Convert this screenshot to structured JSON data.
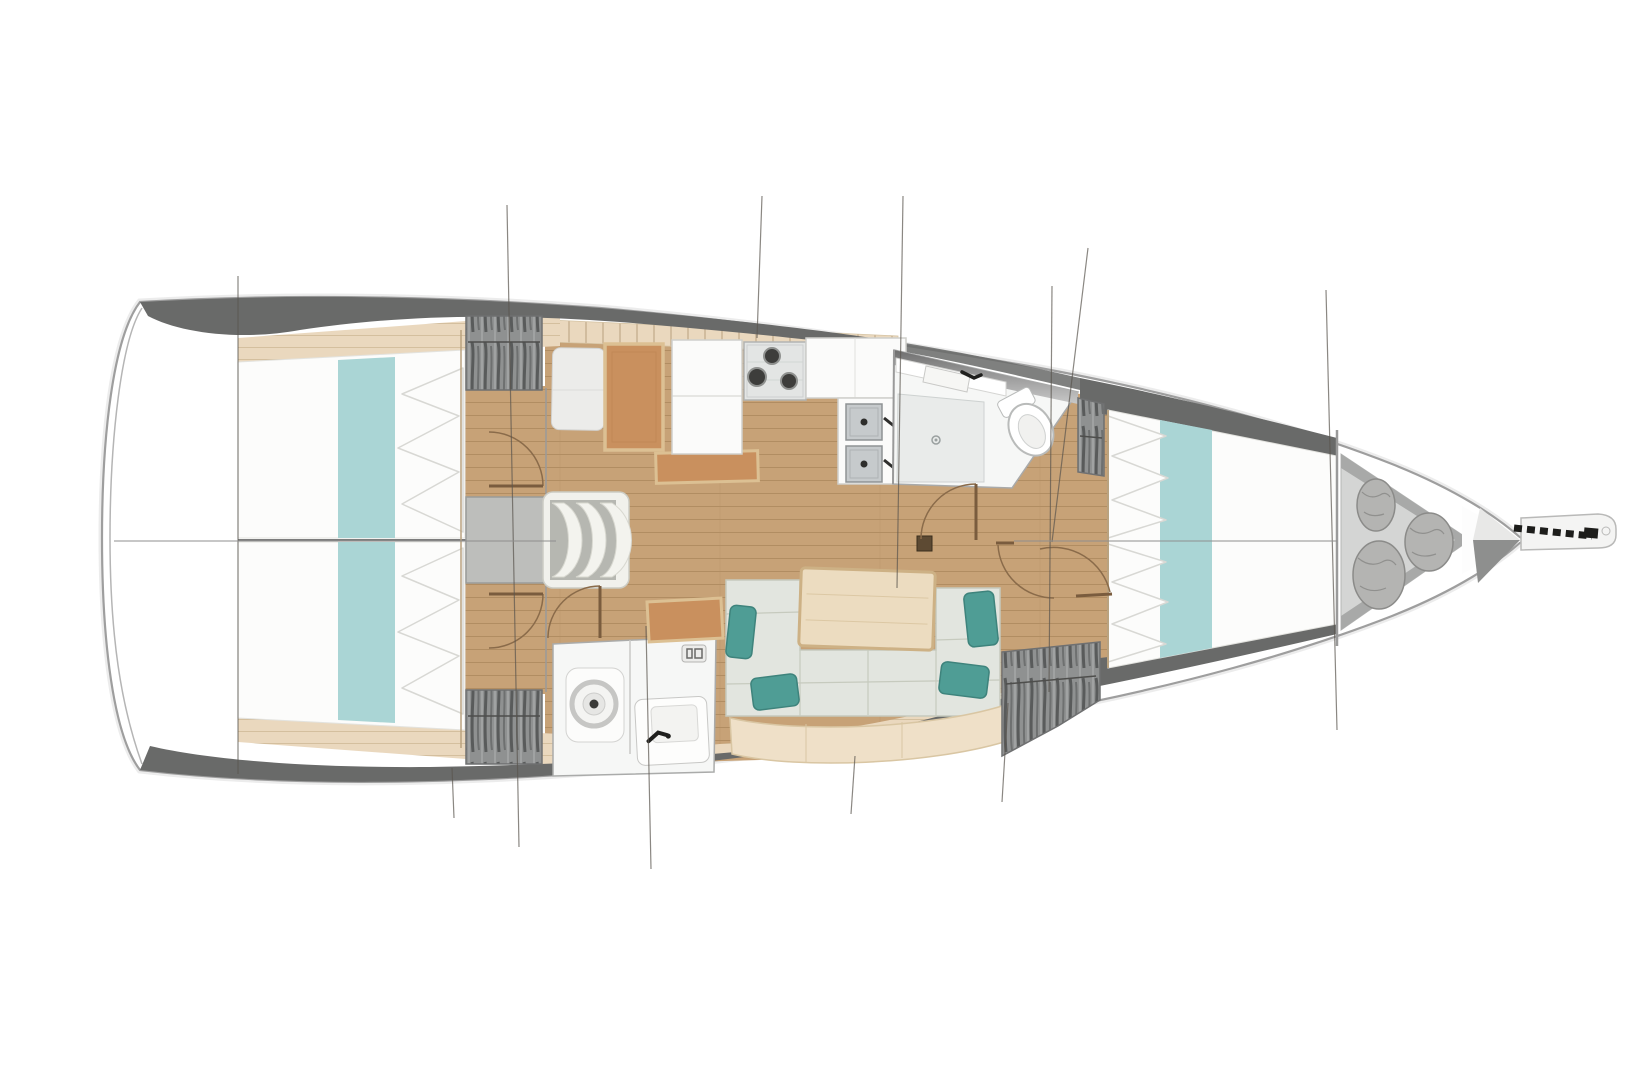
{
  "meta": {
    "title": "Sailing yacht interior floor plan — overhead view, bow to the right"
  },
  "palette": {
    "hull_outline": "#9e9e9e",
    "deck_band": "#696a69",
    "floor_wood": "#c7a277",
    "floor_plank_line": "#b18d62",
    "trim_wood_light": "#ead8be",
    "bedding_white": "#fcfcfb",
    "bed_runner_teal": "#aad5d5",
    "cushion_teal": "#4f9d95",
    "sofa_fabric": "#e2e5df",
    "sofa_backrest": "#efe0c8",
    "table_wood": "#ecdcc0",
    "seat_orange": "#c9905e",
    "orange_trim": "#dcc093",
    "wardrobe_grey": "#8f9191",
    "locker_grey": "#d4d5d4",
    "sail_bag_grey": "#b4b4b2",
    "fixture_white": "#f6f7f6",
    "steel_grey": "#c6cacc",
    "anchor_dark": "#1d1d1b",
    "door_swing_brown": "#8a6b4a"
  },
  "vessel": {
    "view": "top-down interior layout",
    "bow_direction": "right",
    "hull": "monohull sailboat"
  },
  "areas": [
    {
      "id": "transom",
      "label": "Transom / stern platform",
      "furniture": []
    },
    {
      "id": "aft-cabin-port",
      "label": "Aft cabin (port)",
      "furniture": [
        "double berth",
        "teal bed runner",
        "pillows",
        "hanging wardrobe",
        "inward-swinging door"
      ]
    },
    {
      "id": "aft-cabin-starboard",
      "label": "Aft cabin (starboard)",
      "furniture": [
        "double berth",
        "teal bed runner",
        "pillows",
        "hanging wardrobe",
        "inward-swinging door"
      ]
    },
    {
      "id": "companionway",
      "label": "Companionway",
      "furniture": [
        "landing platform",
        "three curved steps"
      ]
    },
    {
      "id": "nav-station",
      "label": "Navigation station",
      "furniture": [
        "seat",
        "chart table",
        "side shelf"
      ]
    },
    {
      "id": "galley",
      "label": "Galley",
      "furniture": [
        "refrigerator / cabinets",
        "three-burner stove",
        "worktop",
        "double stainless sink"
      ]
    },
    {
      "id": "aft-head",
      "label": "Aft head (bathroom)",
      "furniture": [
        "marine toilet",
        "washbasin with faucet",
        "vent grille"
      ]
    },
    {
      "id": "forward-head",
      "label": "Forward head (bathroom)",
      "furniture": [
        "shower floor with drain",
        "washbasin with faucet",
        "marine toilet",
        "hanging wardrobe"
      ]
    },
    {
      "id": "salon",
      "label": "Salon",
      "furniture": [
        "settee",
        "four teal cushions",
        "dining table",
        "mast step",
        "storage bench"
      ]
    },
    {
      "id": "forward-cabin",
      "label": "Forward cabin",
      "furniture": [
        "V-berth double bed",
        "teal bed runner",
        "pillows",
        "hanging wardrobes",
        "door"
      ]
    },
    {
      "id": "sail-locker",
      "label": "Bow sail locker",
      "furniture": [
        "three sail bags"
      ]
    },
    {
      "id": "bow",
      "label": "Bow",
      "furniture": [
        "bowsprit platform",
        "anchor chain roller"
      ]
    }
  ],
  "counts": {
    "cabins": 3,
    "heads": 2,
    "companionway_steps": 3,
    "stove_burners": 3,
    "sink_basins": 2,
    "sail_bags": 3,
    "teal_cushions": 4,
    "door_swings": 6
  },
  "drawing": {
    "station_lines": 11,
    "centerline_segments": 2
  }
}
